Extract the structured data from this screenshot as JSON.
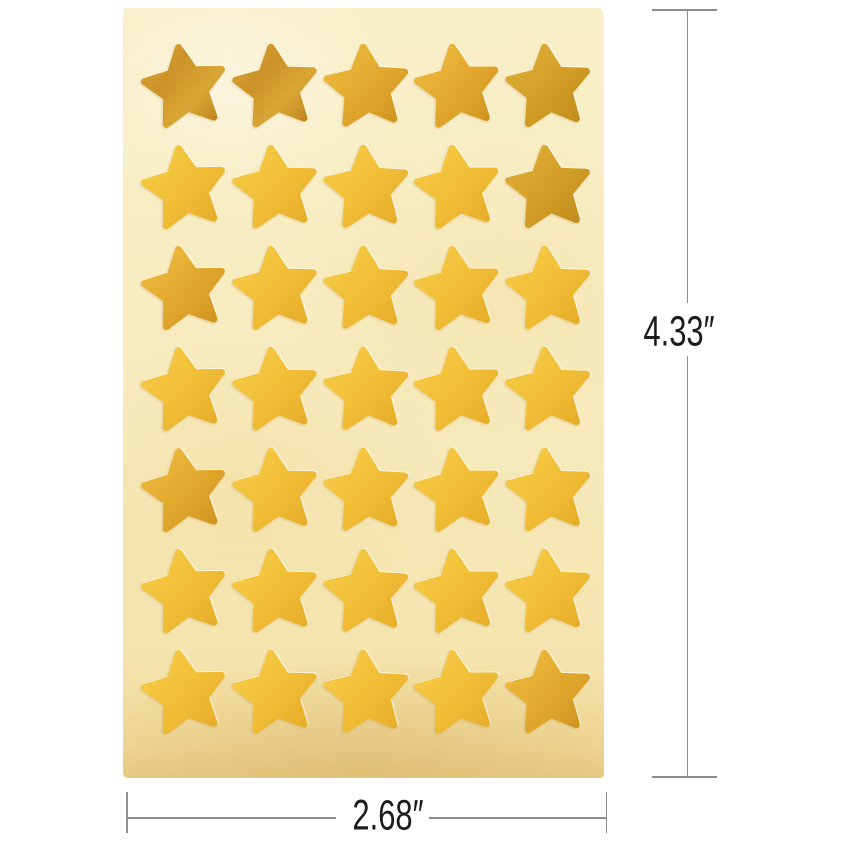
{
  "product": {
    "name": "gold foil star stickers sheet",
    "rows": 7,
    "cols": 5,
    "star_count": 35,
    "sheet_color": "#f7eabc",
    "star_tones": {
      "bright": [
        [
          "0%",
          "#f7cc49"
        ],
        [
          "55%",
          "#f1be36"
        ],
        [
          "100%",
          "#e6ac29"
        ]
      ],
      "gold": [
        [
          "0%",
          "#efbe40"
        ],
        [
          "60%",
          "#e0a62c"
        ],
        [
          "100%",
          "#d0941f"
        ]
      ],
      "dark": [
        [
          "0%",
          "#dba738"
        ],
        [
          "35%",
          "#cc9228"
        ],
        [
          "70%",
          "#d9a635"
        ],
        [
          "100%",
          "#bd831d"
        ]
      ],
      "olive": [
        [
          "0%",
          "#e2b13a"
        ],
        [
          "60%",
          "#d09c26"
        ],
        [
          "100%",
          "#c18c1c"
        ]
      ]
    },
    "stars": [
      "dark",
      "dark",
      "gold",
      "gold",
      "olive",
      "bright",
      "bright",
      "bright",
      "bright",
      "olive",
      "gold",
      "bright",
      "bright",
      "bright",
      "bright",
      "bright",
      "bright",
      "bright",
      "bright",
      "bright",
      "gold",
      "bright",
      "bright",
      "bright",
      "bright",
      "bright",
      "bright",
      "bright",
      "bright",
      "bright",
      "bright",
      "bright",
      "bright",
      "bright",
      "gold"
    ]
  },
  "dimensions": {
    "height_label": "4.33″",
    "width_label": "2.68″",
    "line_color": "#8d8d8d",
    "text_color": "#1c1c1c"
  }
}
